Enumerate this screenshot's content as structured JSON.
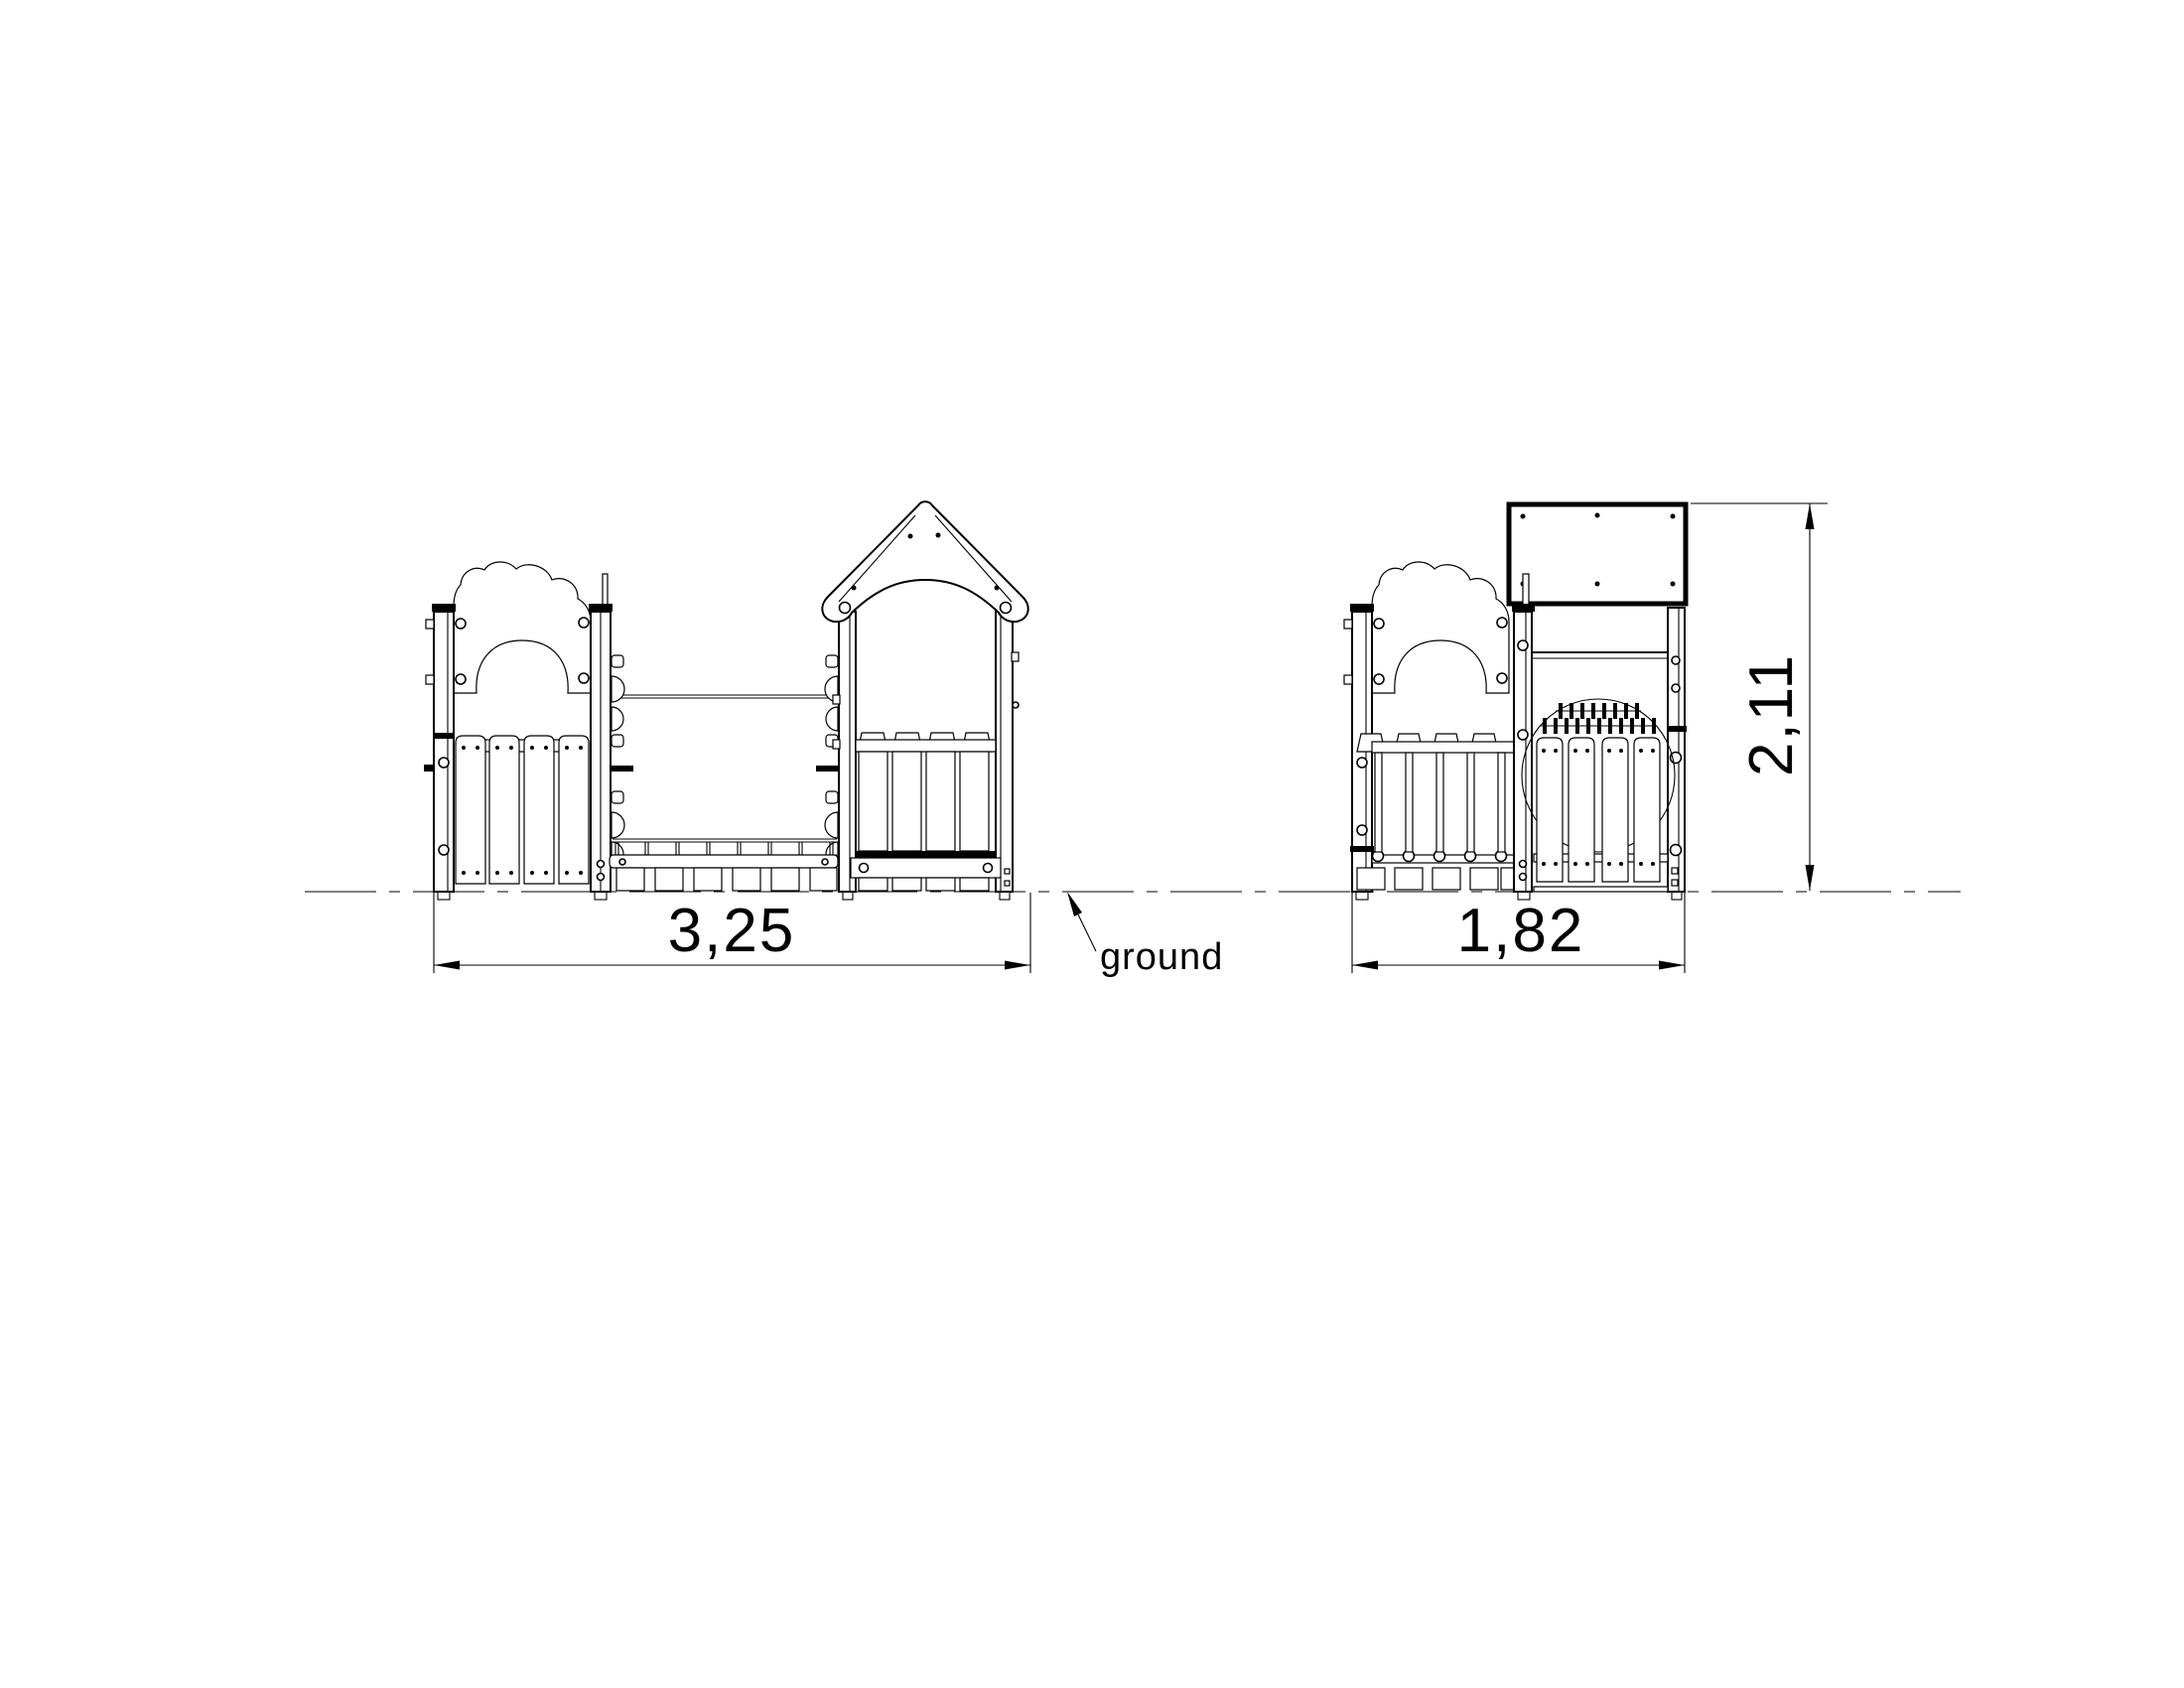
{
  "page": {
    "background": "#ffffff",
    "line_color": "#000000"
  },
  "dimensions": {
    "front_width": "3,25",
    "side_width": "1,82",
    "overall_height": "2,11"
  },
  "labels": {
    "ground": "ground"
  }
}
